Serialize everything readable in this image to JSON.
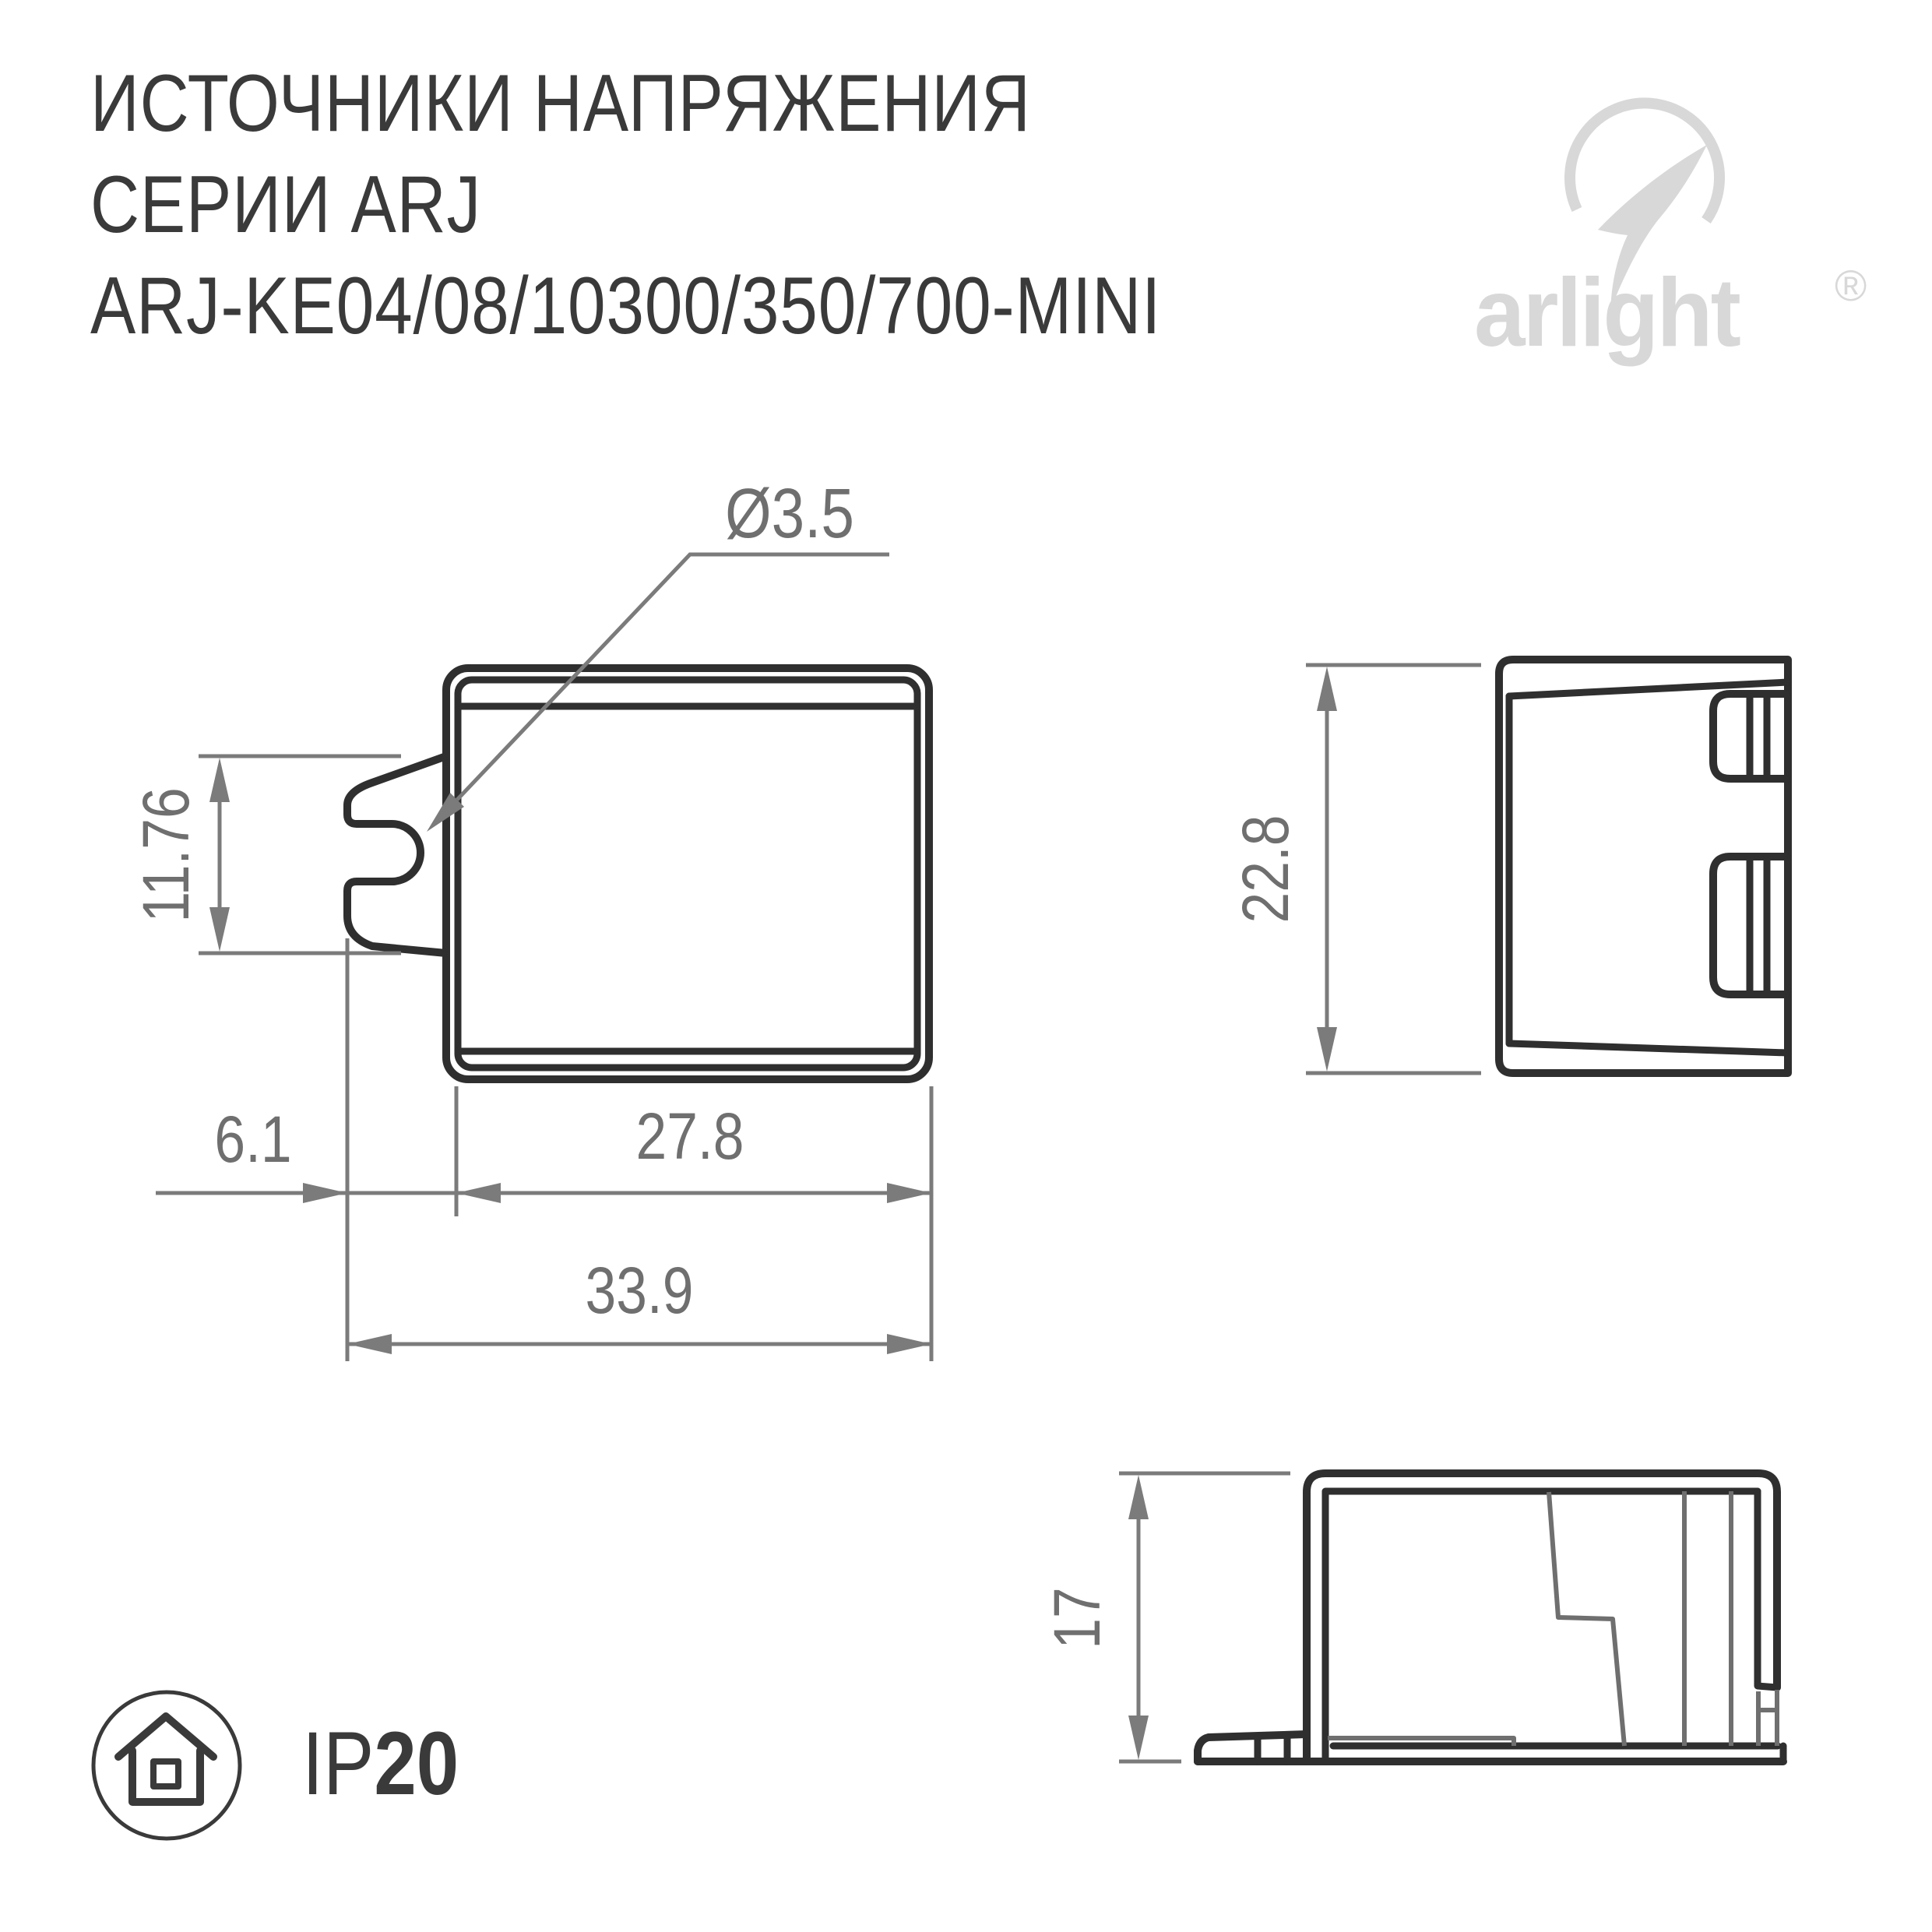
{
  "title": {
    "line1": "ИСТОЧНИКИ НАПРЯЖЕНИЯ",
    "line2": "СЕРИИ ARJ",
    "line3": "ARJ-KE04/08/10300/350/700-MINI"
  },
  "logo": {
    "name": "arlight",
    "registered": "®"
  },
  "drawing": {
    "front_view": {
      "hole_diameter": "Ø3.5",
      "tab_height": "11.76",
      "tab_width": "6.1",
      "body_width": "27.8",
      "total_width": "33.9"
    },
    "side_view": {
      "height": "22.8"
    },
    "profile_view": {
      "height": "17"
    }
  },
  "protection": {
    "prefix": "IP",
    "rating": "20"
  },
  "colors": {
    "outline_dark": "#2f2f2f",
    "dimension_line": "#7b7b7b",
    "dimension_text": "#6f6f6f",
    "title_text": "#3a3a3a",
    "logo_gray": "#d8d8d8",
    "background": "#ffffff"
  }
}
